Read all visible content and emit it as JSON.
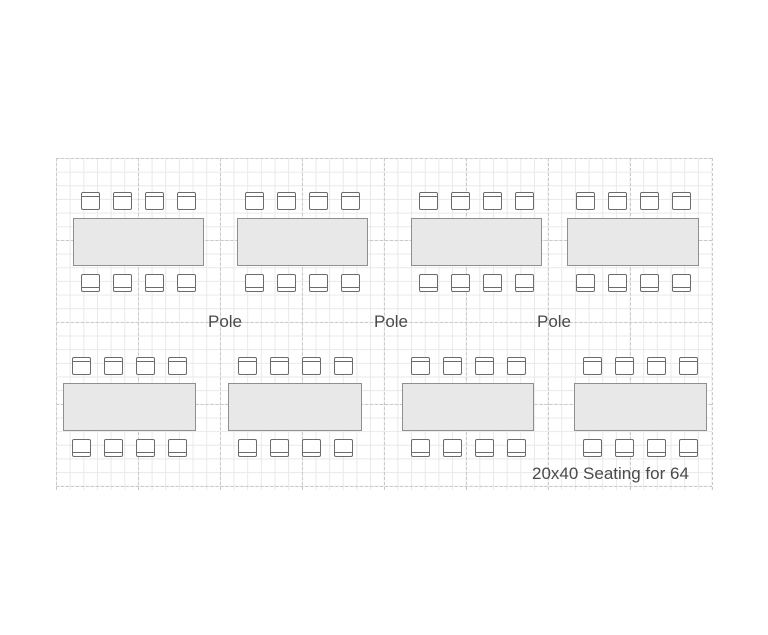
{
  "floorplan": {
    "caption": "20x40 Seating for 64",
    "pole_labels": [
      {
        "label": "Pole",
        "x": 225
      },
      {
        "label": "Pole",
        "x": 391
      },
      {
        "label": "Pole",
        "x": 554
      }
    ],
    "tables": [
      {
        "id": "table-1",
        "row": "top",
        "x": 73,
        "y": 192,
        "width": 131,
        "chairs_top": 4,
        "chairs_bottom": 4
      },
      {
        "id": "table-2",
        "row": "top",
        "x": 237,
        "y": 192,
        "width": 131,
        "chairs_top": 4,
        "chairs_bottom": 4
      },
      {
        "id": "table-3",
        "row": "top",
        "x": 411,
        "y": 192,
        "width": 131,
        "chairs_top": 4,
        "chairs_bottom": 4
      },
      {
        "id": "table-4",
        "row": "top",
        "x": 567,
        "y": 192,
        "width": 132,
        "chairs_top": 4,
        "chairs_bottom": 4
      },
      {
        "id": "table-5",
        "row": "bottom",
        "x": 63,
        "y": 357,
        "width": 133,
        "chairs_top": 4,
        "chairs_bottom": 4
      },
      {
        "id": "table-6",
        "row": "bottom",
        "x": 228,
        "y": 357,
        "width": 134,
        "chairs_top": 4,
        "chairs_bottom": 4
      },
      {
        "id": "table-7",
        "row": "bottom",
        "x": 402,
        "y": 357,
        "width": 132,
        "chairs_top": 4,
        "chairs_bottom": 4
      },
      {
        "id": "table-8",
        "row": "bottom",
        "x": 574,
        "y": 357,
        "width": 133,
        "chairs_top": 4,
        "chairs_bottom": 4
      }
    ],
    "grid": {
      "x": 56,
      "y": 158,
      "width": 656,
      "height": 332,
      "minor_step": 13.667,
      "major_step": 82,
      "major_vertical_count": 9,
      "major_horizontal_count": 5
    },
    "colors": {
      "table_fill": "#e8e8e8",
      "table_border": "#8f8f8f",
      "chair_border": "#6b6b6b",
      "grid_minor": "#e9e9e9",
      "grid_major": "#c9c9c9",
      "text": "#4a4a4a"
    }
  }
}
